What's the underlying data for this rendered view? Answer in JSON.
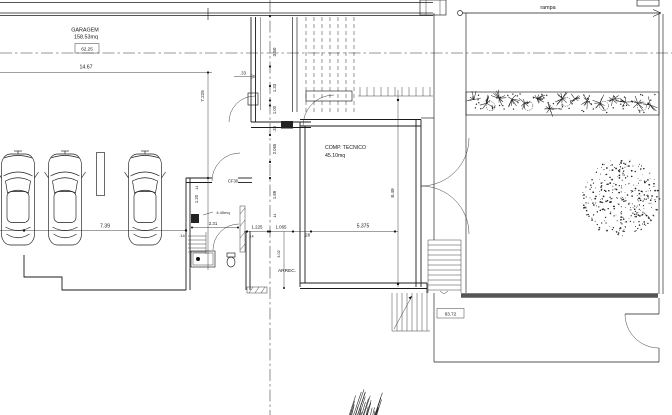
{
  "plan": {
    "rooms": {
      "garagem_name": "GARAGEM",
      "garagem_area": "158.53mq",
      "garagem_level": "62.25",
      "comp_name": "COMP.  TECNICO",
      "comp_area": "45.10mq",
      "arrec": "ARREC.",
      "wc_area": "4.40mq",
      "rampa": "rampa",
      "patio_level": "63.72",
      "door_code": "CF30"
    },
    "dims": {
      "w_garage": "14.67",
      "w_bay": "7.39",
      "h_garage": "7.225",
      "v1": "3.50",
      "v2": "1.33",
      "v3": "1.00",
      "v4": ".33",
      "v5": "2.065",
      "v6": "1.89",
      "h1": ".33",
      "h2": "2.31",
      "h3": "1.225",
      "h4": "1.065",
      "h5": ".28",
      "h6": "5.375",
      "v7": "1.20",
      "v8": "3.02",
      "h_room": "8.49",
      "t14a": ".14",
      "t14b": ".14",
      "t14c": ".14",
      "t14d": ".14"
    }
  }
}
